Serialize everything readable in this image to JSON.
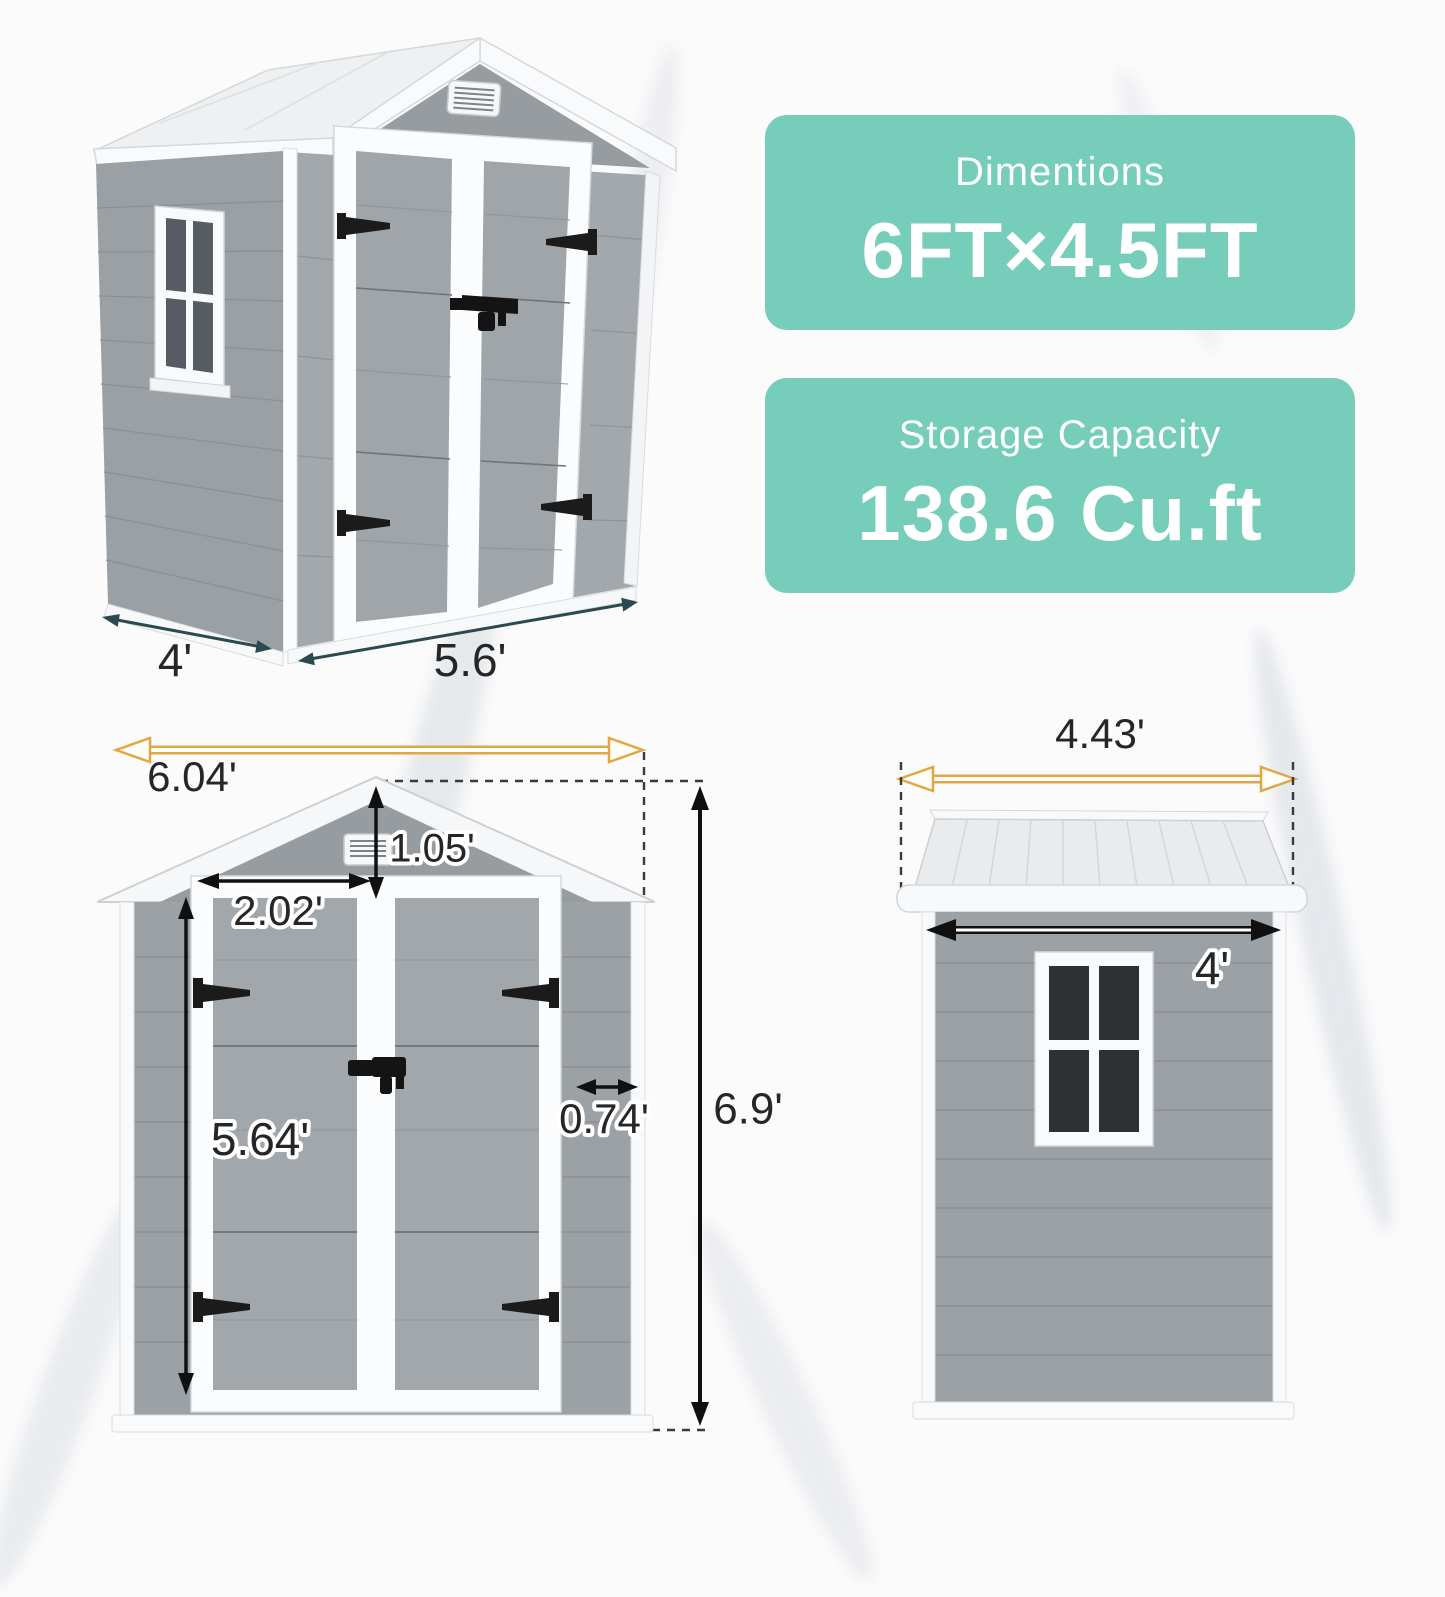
{
  "cards": [
    {
      "title": "Dimentions",
      "value": "6FT×4.5FT"
    },
    {
      "title": "Storage Capacity",
      "value": "138.6 Cu.ft"
    }
  ],
  "dims": {
    "perspective_depth": "4'",
    "perspective_width": "5.6'",
    "front_width": "6.04'",
    "gable_height": "1.05'",
    "door_width": "2.02'",
    "door_height": "5.64'",
    "side_panel": "0.74'",
    "total_height": "6.9'",
    "roof_width": "4.43'",
    "side_width": "4'"
  },
  "colors": {
    "teal": "#76cdb9",
    "arrow_yellow": "#e0a843",
    "arrow_dark_teal": "#2a4a50",
    "arrow_black": "#101010",
    "wall_gray": "#9ca1a6",
    "roof_white": "#f6f7f8",
    "window_pane": "#2e3134",
    "label_text": "#262626"
  }
}
